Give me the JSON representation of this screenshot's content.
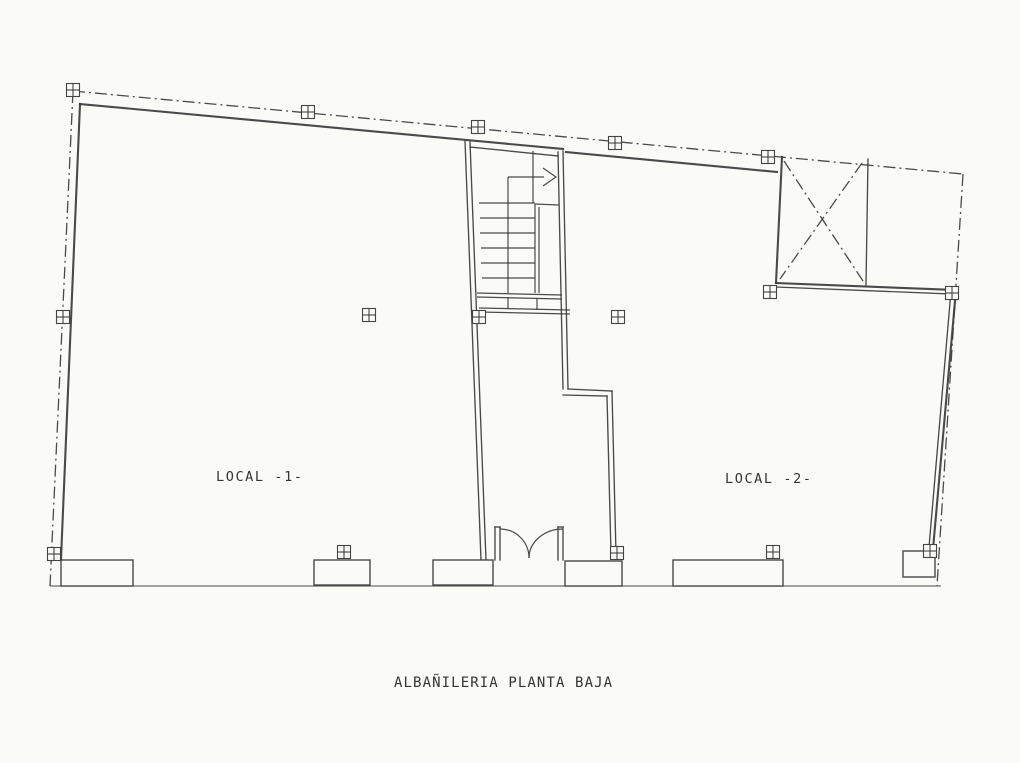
{
  "drawing": {
    "title": "ALBAÑILERIA PLANTA BAJA",
    "rooms": [
      {
        "label": "LOCAL -1-"
      },
      {
        "label": "LOCAL -2-"
      }
    ],
    "symbols": {
      "column_marker": "crossed-square-column-marker",
      "stair_arrow": "stair-direction-arrow",
      "patio_cross": "diagonal-cross-shaft",
      "entrance": "double-swing-door",
      "boundary": "dash-dot-property-line"
    },
    "colors": {
      "paper": "#fafaf7",
      "ink": "#3b3b3b"
    }
  }
}
